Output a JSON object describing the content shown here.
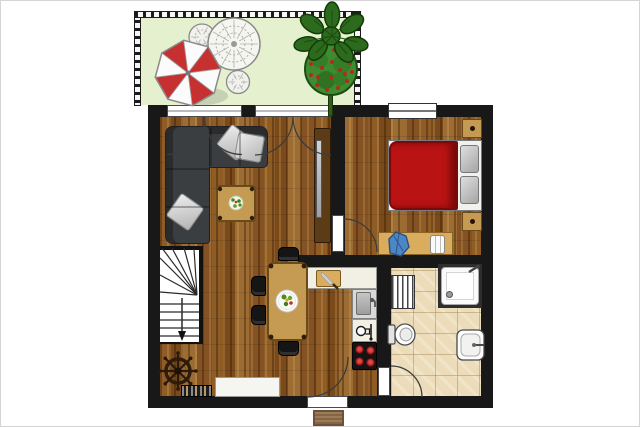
{
  "scene": {
    "kind": "apartment-floor-plan-illustration",
    "visible_text": ""
  },
  "palette": {
    "wall": "#181818",
    "terrace": "#e5f0cf",
    "wood_base": "#8a5826",
    "tile": "#ecdcba",
    "sofa": "#3b3e41",
    "cushion_gray": "#cfcfcf",
    "table_wood": "#c59a52",
    "table_edge": "#6b4a1a",
    "bed_red": "#b91313",
    "bed_red_dark": "#7c0909",
    "parasol_red": "#c63030",
    "leaf_dark_green": "#2c6a1d",
    "bush_green": "#3f8b2f",
    "flower_red": "#b52a1c",
    "desk_chair_blue": "#4d86c4",
    "burner_red": "#c22222",
    "counter": "#f2efe5",
    "fixture_white": "#fdfdfd",
    "doormat_brown": "#9c7b55"
  },
  "terrace": {
    "items": [
      "parasol",
      "wicker-table",
      "wicker-chair",
      "wicker-stool",
      "potted-plant"
    ]
  },
  "living_room": {
    "items": [
      "corner-sofa",
      "sofa-cushions",
      "coffee-table",
      "flower-dish",
      "tv-cabinet",
      "tv",
      "french-doors"
    ]
  },
  "bedroom": {
    "items": [
      "double-bed",
      "red-duvet",
      "pillows",
      "nightstand-top",
      "nightstand-bottom",
      "desk",
      "blue-desk-chair",
      "white-chair",
      "window",
      "door"
    ]
  },
  "kitchen": {
    "items": [
      "counter",
      "cutting-board",
      "knife",
      "sink",
      "coffee-machine",
      "stove-four-burners"
    ]
  },
  "dining_area": {
    "items": [
      "dining-table",
      "plate-of-food",
      "four-chairs"
    ]
  },
  "bathroom": {
    "items": [
      "shower",
      "towel-radiator",
      "toilet",
      "washbasin",
      "door"
    ]
  },
  "hall": {
    "items": [
      "winder-stairs",
      "down-arrow",
      "ships-wheel",
      "shoe-rack",
      "white-sideboard",
      "entrance-door",
      "doormat"
    ]
  }
}
